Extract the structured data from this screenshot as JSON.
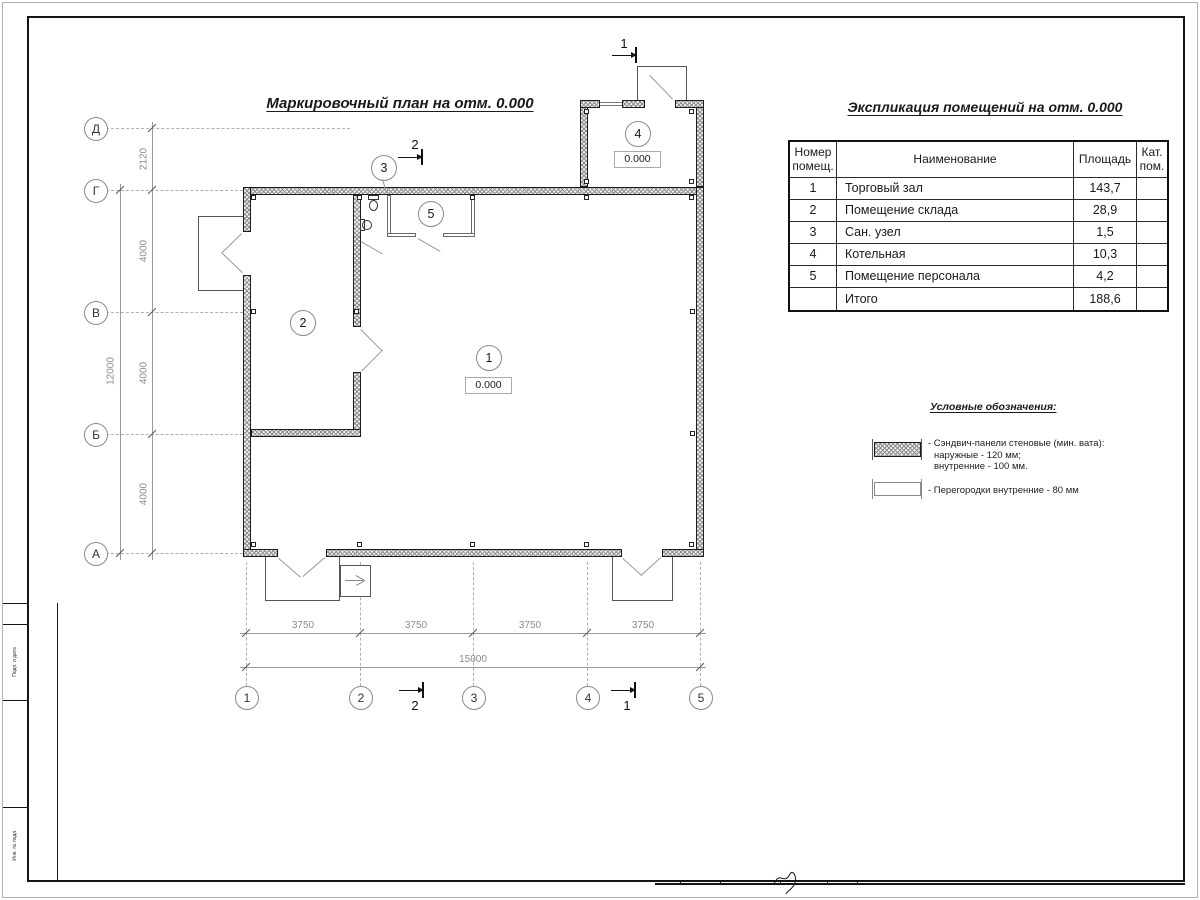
{
  "titles": {
    "plan": "Маркировочный план на отм. 0.000",
    "explication": "Экспликация помещений на отм. 0.000",
    "legend": "Условные обозначения:"
  },
  "table": {
    "col_number": "Номер\nпомещ.",
    "col_name": "Наименование",
    "col_area": "Площадь",
    "col_cat": "Кат.\nпом.",
    "rows": [
      {
        "num": "1",
        "name": "Торговый зал",
        "area": "143,7",
        "cat": ""
      },
      {
        "num": "2",
        "name": "Помещение склада",
        "area": "28,9",
        "cat": ""
      },
      {
        "num": "3",
        "name": "Сан. узел",
        "area": "1,5",
        "cat": ""
      },
      {
        "num": "4",
        "name": "Котельная",
        "area": "10,3",
        "cat": ""
      },
      {
        "num": "5",
        "name": "Помещение персонала",
        "area": "4,2",
        "cat": ""
      }
    ],
    "total_label": "Итого",
    "total_area": "188,6"
  },
  "legend": {
    "item1_line1": "- Сэндвич-панели стеновые (мин. вата):",
    "item1_line2": "наружные - 120 мм;",
    "item1_line3": "внутренние - 100 мм.",
    "item2": "- Перегородки внутренние - 80 мм"
  },
  "axes": {
    "left": [
      "Д",
      "Г",
      "В",
      "Б",
      "А"
    ],
    "bottom": [
      "1",
      "2",
      "3",
      "4",
      "5"
    ]
  },
  "dims": {
    "left_overall": "12000",
    "left_segments": [
      "2120",
      "4000",
      "4000",
      "4000"
    ],
    "bottom_overall": "15000",
    "bottom_segments": [
      "3750",
      "3750",
      "3750",
      "3750"
    ]
  },
  "rooms": [
    {
      "num": "1",
      "elev": "0.000"
    },
    {
      "num": "2"
    },
    {
      "num": "3"
    },
    {
      "num": "4",
      "elev": "0.000"
    },
    {
      "num": "5"
    }
  ],
  "sections": {
    "one": "1",
    "two": "2"
  },
  "titleblock": {
    "side1": "Подп. и дата",
    "side2": "Инв. № подл."
  },
  "colors": {
    "ink": "#1a1a1a",
    "dim": "#8a8a8a"
  }
}
